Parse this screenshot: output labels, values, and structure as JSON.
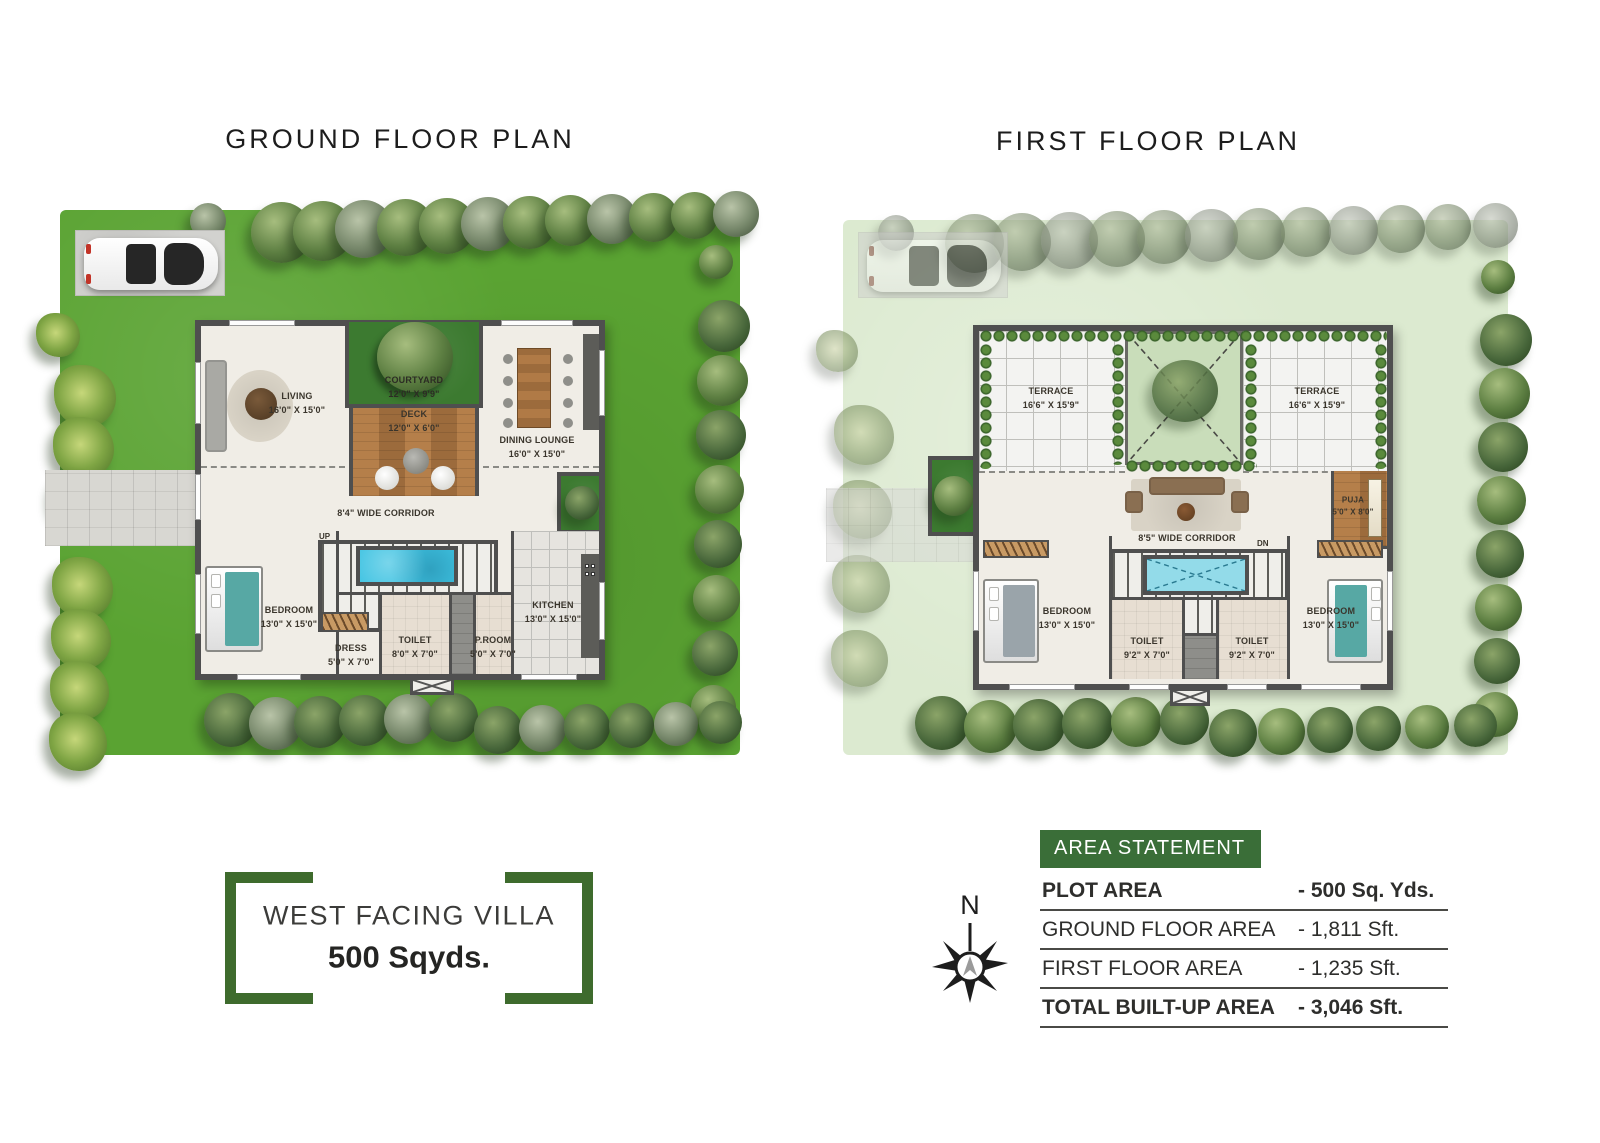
{
  "ground_floor": {
    "title": "GROUND FLOOR PLAN",
    "stairs_label": "UP",
    "rooms": {
      "living": {
        "name": "LIVING",
        "dims": "16'0\" X 15'0\""
      },
      "courtyard": {
        "name": "COURTYARD",
        "dims": "12'0\" X 9'9\""
      },
      "deck": {
        "name": "DECK",
        "dims": "12'0\" X 6'0\""
      },
      "dining_lounge": {
        "name": "DINING LOUNGE",
        "dims": "16'0\" X 15'0\""
      },
      "corridor": {
        "name": "8'4\" WIDE CORRIDOR"
      },
      "bedroom": {
        "name": "BEDROOM",
        "dims": "13'0\" X 15'0\""
      },
      "dress": {
        "name": "DRESS",
        "dims": "5'0\" X 7'0\""
      },
      "toilet": {
        "name": "TOILET",
        "dims": "8'0\" X 7'0\""
      },
      "p_room": {
        "name": "P.ROOM",
        "dims": "5'0\" X 7'0\""
      },
      "kitchen": {
        "name": "KITCHEN",
        "dims": "13'0\" X 15'0\""
      }
    }
  },
  "first_floor": {
    "title": "FIRST FLOOR PLAN",
    "stairs_label": "DN",
    "rooms": {
      "terrace_left": {
        "name": "TERRACE",
        "dims": "16'6\" X 15'9\""
      },
      "terrace_right": {
        "name": "TERRACE",
        "dims": "16'6\" X 15'9\""
      },
      "corridor": {
        "name": "8'5\" WIDE CORRIDOR"
      },
      "puja": {
        "name": "PUJA",
        "dims": "5'0\" X 8'0\""
      },
      "bedroom_left": {
        "name": "BEDROOM",
        "dims": "13'0\" X 15'0\""
      },
      "toilet_left": {
        "name": "TOILET",
        "dims": "9'2\" X 7'0\""
      },
      "toilet_right": {
        "name": "TOILET",
        "dims": "9'2\" X 7'0\""
      },
      "bedroom_right": {
        "name": "BEDROOM",
        "dims": "13'0\" X 15'0\""
      }
    }
  },
  "villa_badge": {
    "line1": "WEST FACING VILLA",
    "line2": "500 Sqyds."
  },
  "compass": {
    "north_label": "N"
  },
  "area_statement": {
    "header": "AREA STATEMENT",
    "rows": [
      {
        "label": "PLOT AREA",
        "value": "- 500 Sq. Yds."
      },
      {
        "label": "GROUND FLOOR AREA",
        "value": "- 1,811 Sft."
      },
      {
        "label": "FIRST FLOOR AREA",
        "value": "- 1,235 Sft."
      },
      {
        "label": "TOTAL BUILT-UP AREA",
        "value": "- 3,046 Sft."
      }
    ]
  },
  "colors": {
    "accent-green": "#3e6b2d",
    "header-green": "#3a6e38",
    "lawn": "#5aa332",
    "faded-lawn": "#dcead0",
    "pool": "#3fc3e2",
    "pool-light": "#93dbe9",
    "wall": "#4f4f4f",
    "wood": "#a9743f"
  }
}
